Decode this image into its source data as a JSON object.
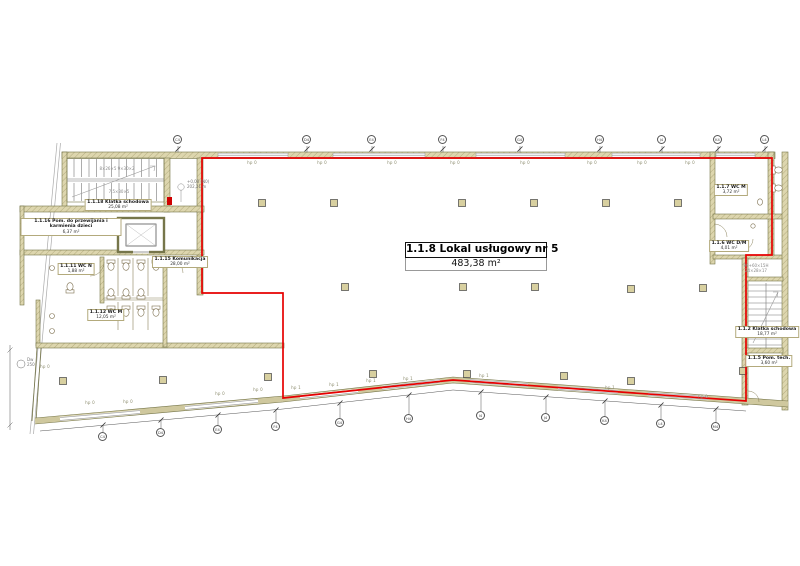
{
  "plan": {
    "main_label": {
      "title": "1.1.8 Lokal usługowy nr 5",
      "area": "483,38 m²"
    },
    "rooms": {
      "klatka18": {
        "name": "1.1.18 Klatka schodowa",
        "area": "25,08 m²"
      },
      "pom16": {
        "name": "1.1.16 Pom. do przewijania i karmienia dzieci",
        "area": "6,37 m²"
      },
      "kom15": {
        "name": "1.1.15 Komunikacja",
        "area": "28,00 m²"
      },
      "wc11": {
        "name": "1.1.11 WC N",
        "area": "1,88 m²"
      },
      "wc12": {
        "name": "1.1.12 WC M",
        "area": "12,05 m²"
      },
      "wc7": {
        "name": "1.1.7 WC M",
        "area": "3,72 m²"
      },
      "wc6": {
        "name": "1.1.6 WC D/M",
        "area": "4,01 m²"
      },
      "klatka2": {
        "name": "1.1.2 Klatka schodowa",
        "area": "18,77 m²"
      },
      "pom5": {
        "name": "1.1.5 Pom. tech.",
        "area": "3,60 m²"
      }
    },
    "annotations": {
      "hp0": "hp 0",
      "hp1": "hp 1",
      "elevation_label": "+0,00 (N0)",
      "elevation_value": "202,21 m",
      "stair_note_left_1": "8×26×5  9×30×2",
      "stair_note_left_2": "7,5×30×5",
      "stair_note_right_1": "90+60×15H",
      "stair_note_right_2": "24×28×17",
      "door_marker_id": "Dw",
      "door_marker_value": "250"
    },
    "grid_top": [
      "C4",
      "D4",
      "E4",
      "F4",
      "G4",
      "H4",
      "J4",
      "K4",
      "L4"
    ],
    "grid_bottom": [
      "C4",
      "D4",
      "E4",
      "F4",
      "G4",
      "H4",
      "I4",
      "J4",
      "K4",
      "L4",
      "M4"
    ]
  }
}
